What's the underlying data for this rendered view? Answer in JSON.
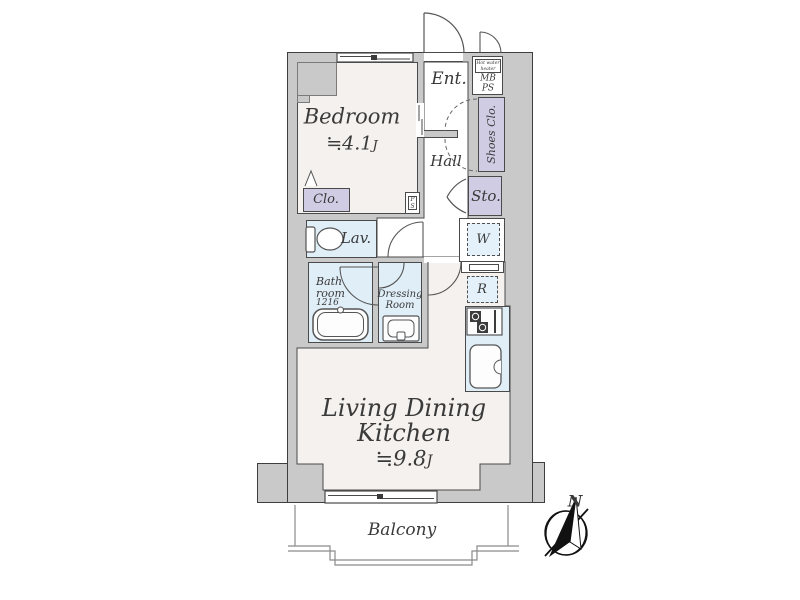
{
  "colors": {
    "wall_fill": "#c9c9c9",
    "outline": "#4a4a4a",
    "room_floor": "#f4f1ee",
    "wet_room": "#e0eef8",
    "closet_fill": "#cfcce4",
    "appliance_fill": "#e4f1fa",
    "text": "#3a3a3a"
  },
  "rooms": {
    "bedroom": {
      "name": "Bedroom",
      "size": "≒4.1",
      "size_unit": "J"
    },
    "ldk": {
      "name_line1": "Living Dining",
      "name_line2": "Kitchen",
      "size": "≒9.8",
      "size_unit": "J"
    },
    "entrance": {
      "label": "Ent."
    },
    "hall": {
      "label": "Hall"
    },
    "lavatory": {
      "label": "Lav."
    },
    "bathroom": {
      "label_line1": "Bath",
      "label_line2": "room",
      "size_code": "1216"
    },
    "dressing_room": {
      "label_line1": "Dressing",
      "label_line2": "Room"
    },
    "balcony": {
      "label": "Balcony"
    }
  },
  "storage": {
    "bedroom_closet": {
      "label": "Clo."
    },
    "shoes_closet": {
      "label": "Shoes Clo."
    },
    "hall_storage": {
      "label": "Sto."
    }
  },
  "equipment": {
    "meter_box": {
      "line1": "MB",
      "line2": "PS"
    },
    "water_heater": {
      "line1": "Hot water",
      "line2": "heater"
    },
    "pipe_space": {
      "line1": "P",
      "line2": "S"
    },
    "washer": {
      "label": "W"
    },
    "refrigerator": {
      "label": "R"
    }
  },
  "compass": {
    "north": "N"
  }
}
